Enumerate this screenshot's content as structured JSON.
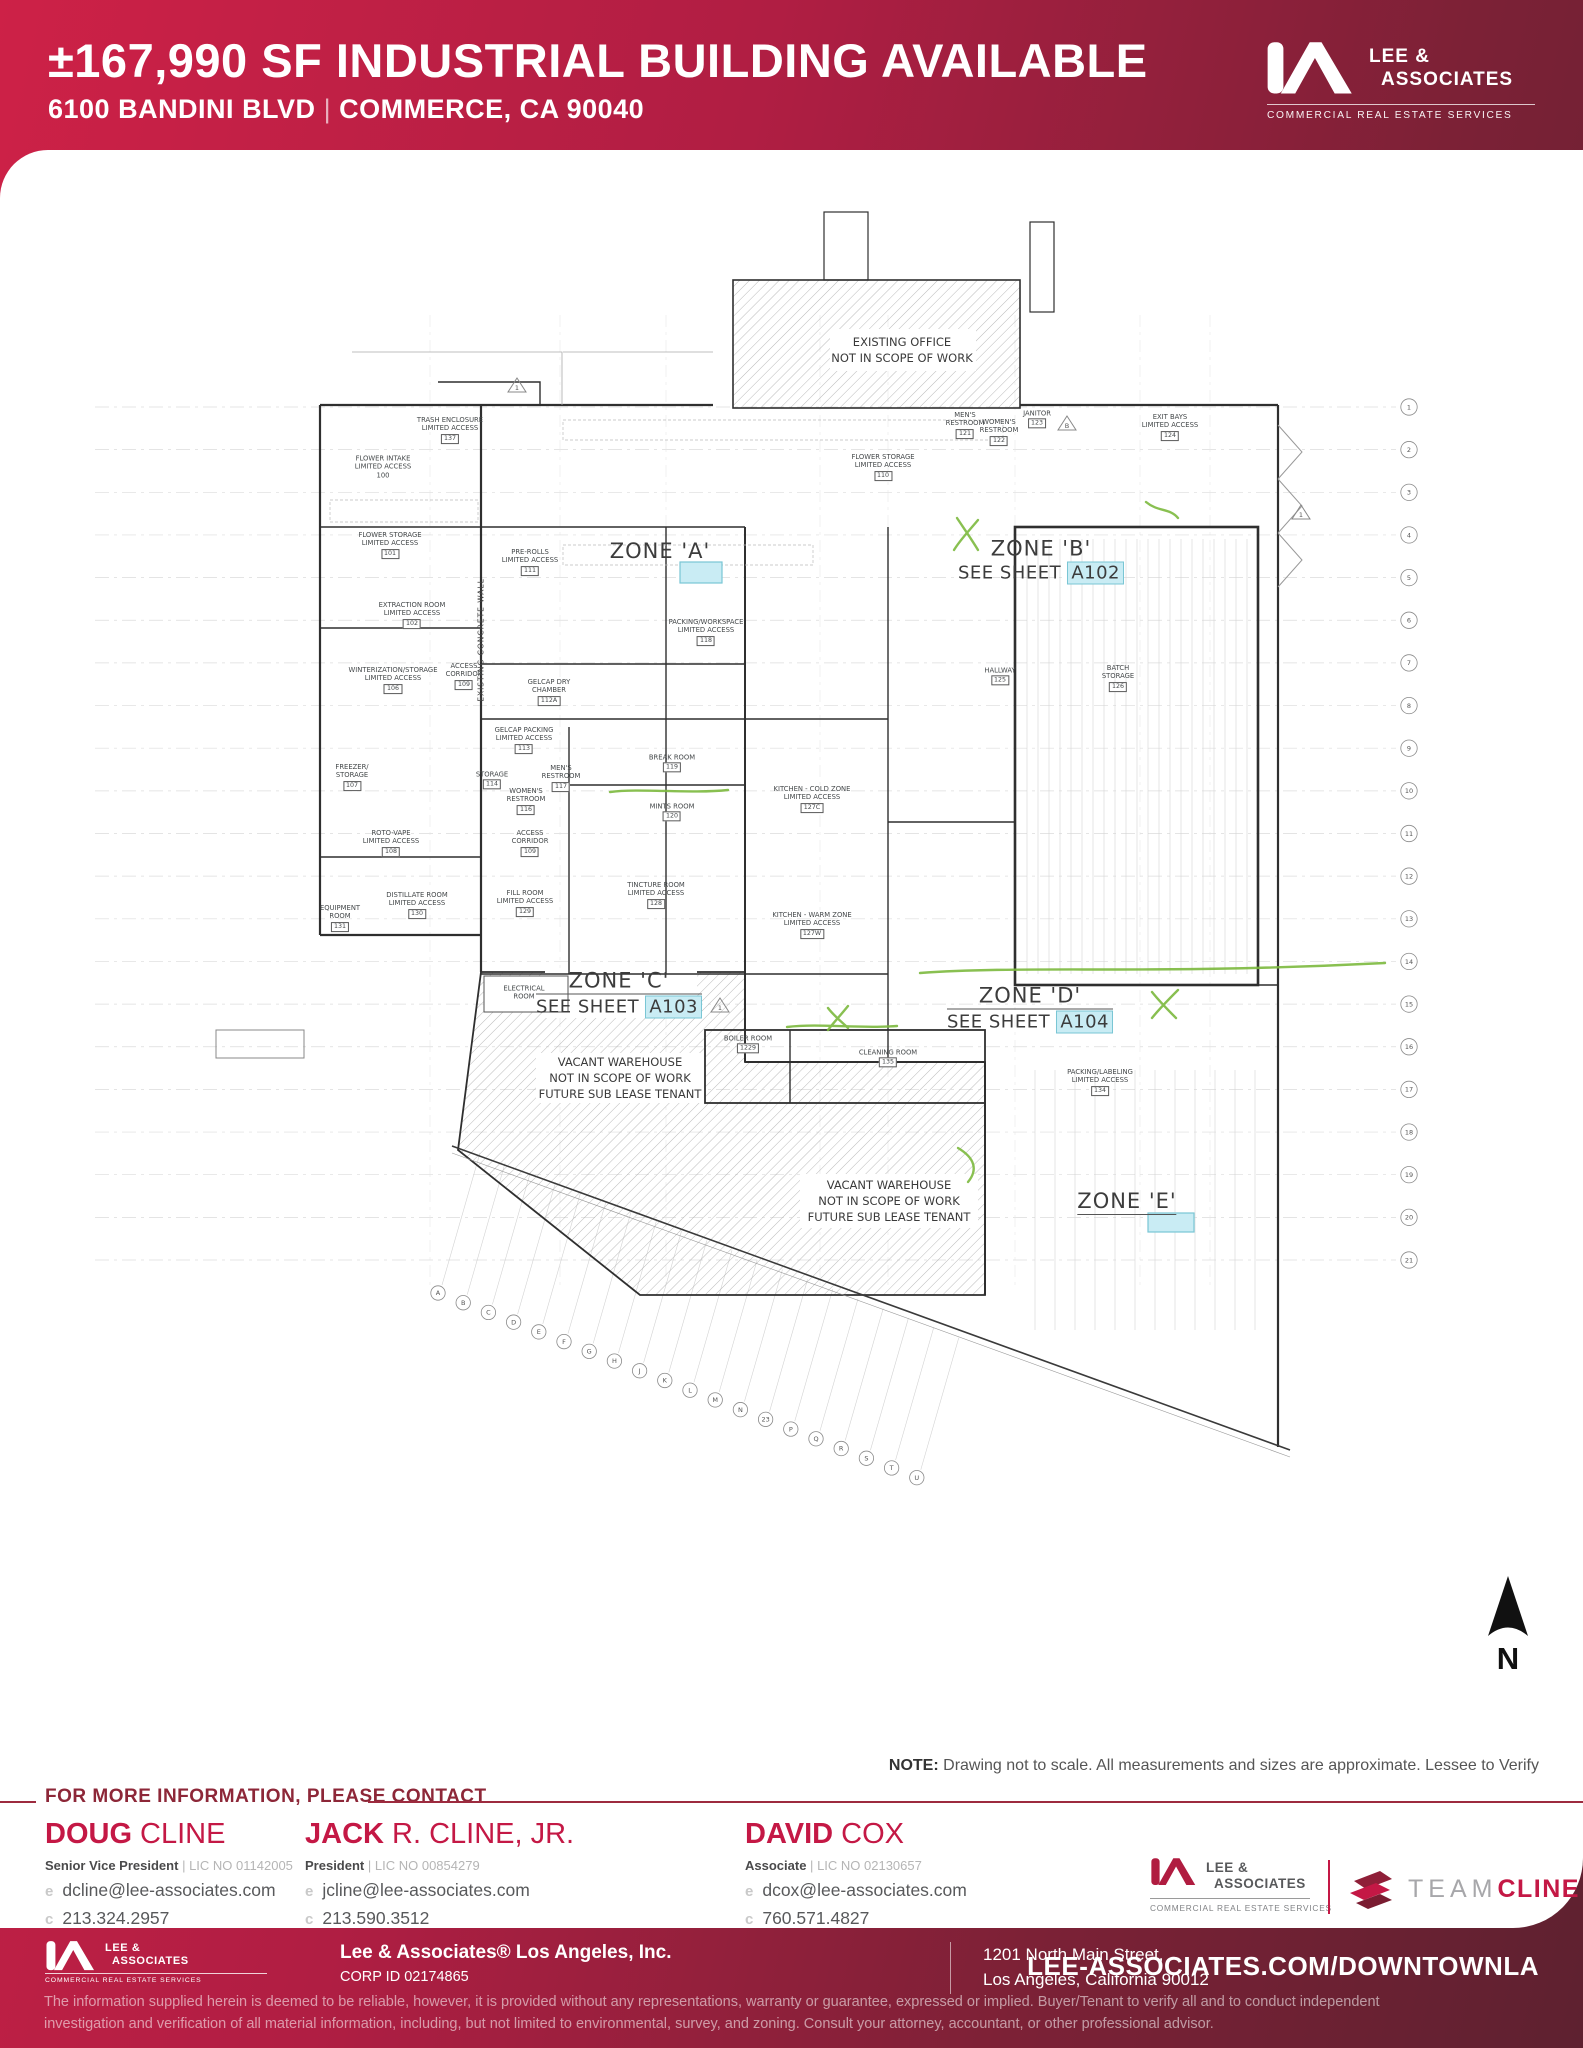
{
  "header": {
    "title": "±167,990 SF INDUSTRIAL BUILDING AVAILABLE",
    "address": "6100 BANDINI BLVD",
    "separator": "|",
    "city_state": "COMMERCE, CA 90040"
  },
  "brand": {
    "line1": "LEE &",
    "line2": "ASSOCIATES",
    "tagline": "COMMERCIAL REAL ESTATE SERVICES",
    "accent_red": "#c41845",
    "dark_maroon": "#5e2130",
    "highlight_cyan": "#c9ecf4",
    "annotation_green": "#7cb93e"
  },
  "plan": {
    "existing_office": [
      "EXISTING OFFICE",
      "NOT IN SCOPE OF WORK"
    ],
    "vacant_warehouse": [
      "VACANT WAREHOUSE",
      "NOT IN SCOPE OF WORK",
      "FUTURE SUB LEASE TENANT"
    ],
    "concrete_wall": "EXISTING CONCRETE WALL",
    "compass": "N",
    "zones": [
      {
        "label": "ZONE 'A'"
      },
      {
        "label": "ZONE 'B'",
        "sheet_prefix": "SEE SHEET",
        "sheet": "A102"
      },
      {
        "label": "ZONE 'C'",
        "sheet_prefix": "SEE SHEET",
        "sheet": "A103"
      },
      {
        "label": "ZONE 'D'",
        "sheet_prefix": "SEE SHEET",
        "sheet": "A104"
      },
      {
        "label": "ZONE 'E'"
      }
    ],
    "grid": {
      "numbers": [
        "1",
        "2",
        "3",
        "4",
        "5",
        "6",
        "7",
        "8",
        "9",
        "10",
        "11",
        "12",
        "13",
        "14",
        "15",
        "16",
        "17",
        "18",
        "19",
        "20",
        "21"
      ],
      "letters": [
        "A",
        "B",
        "C",
        "D",
        "E",
        "F",
        "G",
        "H",
        "J",
        "K",
        "L",
        "M",
        "N",
        "23",
        "P",
        "Q",
        "R",
        "S",
        "T",
        "U"
      ]
    },
    "triangles": [
      {
        "x": 517,
        "y": 386,
        "t": "1"
      },
      {
        "x": 1067,
        "y": 424,
        "t": "B"
      },
      {
        "x": 1301,
        "y": 513,
        "t": "1"
      },
      {
        "x": 720,
        "y": 1006,
        "t": "1"
      }
    ],
    "rooms": [
      {
        "x": 450,
        "y": 430,
        "l": [
          "TRASH ENCLOSURE",
          "LIMITED ACCESS"
        ],
        "n": "137"
      },
      {
        "x": 383,
        "y": 467,
        "l": [
          "FLOWER INTAKE",
          "LIMITED ACCESS",
          "100"
        ]
      },
      {
        "x": 883,
        "y": 467,
        "l": [
          "FLOWER STORAGE",
          "LIMITED ACCESS"
        ],
        "n": "110"
      },
      {
        "x": 390,
        "y": 545,
        "l": [
          "FLOWER STORAGE",
          "LIMITED ACCESS"
        ],
        "n": "101"
      },
      {
        "x": 530,
        "y": 562,
        "l": [
          "PRE-ROLLS",
          "LIMITED ACCESS"
        ],
        "n": "111"
      },
      {
        "x": 412,
        "y": 615,
        "l": [
          "EXTRACTION ROOM",
          "LIMITED ACCESS"
        ],
        "n": "102"
      },
      {
        "x": 393,
        "y": 680,
        "l": [
          "WINTERIZATION/STORAGE",
          "LIMITED ACCESS"
        ],
        "n": "106"
      },
      {
        "x": 464,
        "y": 676,
        "l": [
          "ACCESS",
          "CORRIDOR"
        ],
        "n": "109"
      },
      {
        "x": 549,
        "y": 692,
        "l": [
          "GELCAP DRY",
          "CHAMBER"
        ],
        "n": "112A"
      },
      {
        "x": 524,
        "y": 740,
        "l": [
          "GELCAP PACKING",
          "LIMITED ACCESS"
        ],
        "n": "113"
      },
      {
        "x": 352,
        "y": 777,
        "l": [
          "FREEZER/",
          "STORAGE"
        ],
        "n": "107"
      },
      {
        "x": 492,
        "y": 780,
        "l": [
          "STORAGE"
        ],
        "n": "114"
      },
      {
        "x": 561,
        "y": 778,
        "l": [
          "MEN'S",
          "RESTROOM"
        ],
        "n": "117"
      },
      {
        "x": 526,
        "y": 801,
        "l": [
          "WOMEN'S",
          "RESTROOM"
        ],
        "n": "116"
      },
      {
        "x": 391,
        "y": 843,
        "l": [
          "ROTO-VAPE",
          "LIMITED ACCESS"
        ],
        "n": "108"
      },
      {
        "x": 530,
        "y": 843,
        "l": [
          "ACCESS",
          "CORRIDOR"
        ],
        "n": "109"
      },
      {
        "x": 672,
        "y": 763,
        "l": [
          "BREAK ROOM"
        ],
        "n": "119"
      },
      {
        "x": 672,
        "y": 812,
        "l": [
          "MINTS ROOM"
        ],
        "n": "120"
      },
      {
        "x": 812,
        "y": 799,
        "l": [
          "KITCHEN - COLD ZONE",
          "LIMITED ACCESS"
        ],
        "n": "127C"
      },
      {
        "x": 812,
        "y": 925,
        "l": [
          "KITCHEN - WARM ZONE",
          "LIMITED ACCESS"
        ],
        "n": "127W"
      },
      {
        "x": 417,
        "y": 905,
        "l": [
          "DISTILLATE ROOM",
          "LIMITED ACCESS"
        ],
        "n": "130"
      },
      {
        "x": 340,
        "y": 918,
        "l": [
          "EQUIPMENT",
          "ROOM"
        ],
        "n": "131"
      },
      {
        "x": 525,
        "y": 903,
        "l": [
          "FILL ROOM",
          "LIMITED ACCESS"
        ],
        "n": "129"
      },
      {
        "x": 656,
        "y": 895,
        "l": [
          "TINCTURE ROOM",
          "LIMITED ACCESS"
        ],
        "n": "128"
      },
      {
        "x": 524,
        "y": 993,
        "l": [
          "ELECTRICAL",
          "ROOM"
        ]
      },
      {
        "x": 965,
        "y": 425,
        "l": [
          "MEN'S",
          "RESTROOM"
        ],
        "n": "121"
      },
      {
        "x": 999,
        "y": 432,
        "l": [
          "WOMEN'S",
          "RESTROOM"
        ],
        "n": "122"
      },
      {
        "x": 1037,
        "y": 419,
        "l": [
          "JANITOR"
        ],
        "n": "123"
      },
      {
        "x": 1170,
        "y": 427,
        "l": [
          "EXIT BAYS",
          "LIMITED ACCESS"
        ],
        "n": "124"
      },
      {
        "x": 706,
        "y": 632,
        "l": [
          "PACKING/WORKSPACE",
          "LIMITED ACCESS"
        ],
        "n": "118"
      },
      {
        "x": 1000,
        "y": 676,
        "l": [
          "HALLWAY"
        ],
        "n": "125"
      },
      {
        "x": 1118,
        "y": 678,
        "l": [
          "BATCH",
          "STORAGE"
        ],
        "n": "126"
      },
      {
        "x": 1100,
        "y": 1082,
        "l": [
          "PACKING/LABELING",
          "LIMITED ACCESS"
        ],
        "n": "134"
      },
      {
        "x": 748,
        "y": 1044,
        "l": [
          "BOILER ROOM"
        ],
        "n": "1229"
      },
      {
        "x": 888,
        "y": 1058,
        "l": [
          "CLEANING ROOM"
        ],
        "n": "135"
      }
    ]
  },
  "note": {
    "label": "NOTE:",
    "text": "Drawing not to scale. All measurements and sizes are approximate. Lessee to Verify"
  },
  "contact": {
    "heading": "FOR MORE INFORMATION, PLEASE CONTACT",
    "email_prefix": "e",
    "phone_prefix": "c",
    "lic_separator": "|",
    "people": [
      {
        "first": "DOUG",
        "last": " CLINE",
        "title": "Senior Vice President",
        "lic": "LIC NO 01142005",
        "email": "dcline@lee-associates.com",
        "phone": "213.324.2957"
      },
      {
        "first": "JACK",
        "last": " R. CLINE, JR.",
        "title": "President",
        "lic": "LIC NO 00854279",
        "email": "jcline@lee-associates.com",
        "phone": "213.590.3512"
      },
      {
        "first": "DAVID",
        "last": " COX",
        "title": "Associate",
        "lic": "LIC NO 02130657",
        "email": "dcox@lee-associates.com",
        "phone": "760.571.4827"
      }
    ]
  },
  "logos": {
    "team": "TEAM",
    "cline": "CLINE"
  },
  "footer": {
    "company": "Lee & Associates® Los Angeles, Inc.",
    "corp_id": "CORP ID 02174865",
    "address_line1": "1201 North Main Street,",
    "address_line2": "Los Angeles, California 90012",
    "website": "LEE-ASSOCIATES.COM/DOWNTOWNLA",
    "disclaimer_line1": "The information supplied herein is deemed to be reliable, however, it is provided without any representations, warranty or guarantee, expressed or implied.  Buyer/Tenant to verify all and to conduct independent",
    "disclaimer_line2": "investigation and verification of all material information, including, but not limited to environmental, survey, and zoning.  Consult your attorney, accountant, or other professional advisor."
  }
}
